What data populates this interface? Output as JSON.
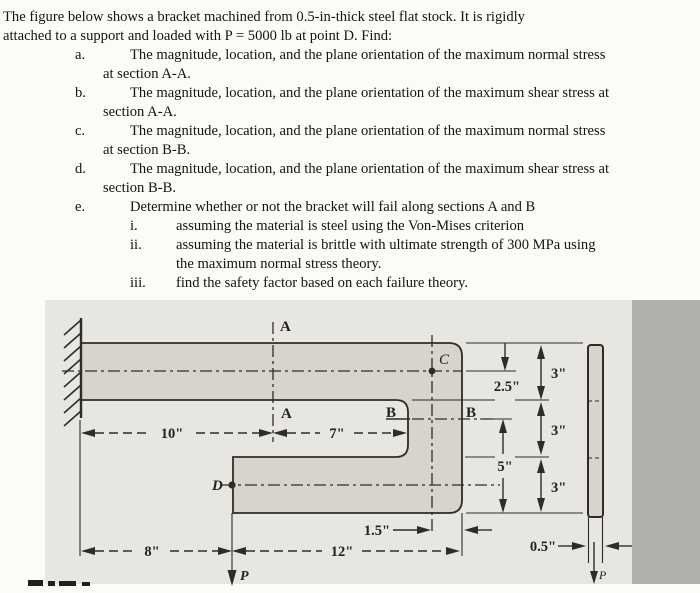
{
  "problem": {
    "intro": [
      "The figure below shows a bracket machined from 0.5-in-thick steel flat stock. It is rigidly",
      "attached to a support and loaded with P = 5000 lb at point D. Find:"
    ],
    "items": [
      {
        "label": "a.",
        "line1": "The magnitude, location, and the plane orientation of the maximum normal stress",
        "line2": "at section A-A."
      },
      {
        "label": "b.",
        "line1": "The magnitude, location, and the plane orientation of the maximum shear stress at",
        "line2": "section A-A."
      },
      {
        "label": "c.",
        "line1": "The magnitude, location, and the plane orientation of the maximum normal stress",
        "line2": "at section B-B."
      },
      {
        "label": "d.",
        "line1": "The magnitude, location, and the plane orientation of the maximum shear stress at",
        "line2": "section B-B."
      },
      {
        "label": "e.",
        "line1": "Determine whether or not the bracket will fail along sections A and B"
      }
    ],
    "subitems": [
      {
        "label": "i.",
        "line1": "assuming the material is steel using the Von-Mises criterion"
      },
      {
        "label": "ii.",
        "line1": "assuming the material is brittle with ultimate strength of 300 MPa using",
        "line2": "the maximum normal stress theory."
      },
      {
        "label": "iii.",
        "line1": "find the safety factor based on each failure theory."
      }
    ]
  },
  "figure": {
    "section_labels": {
      "a_top": "A",
      "a_bottom": "A",
      "b_left": "B",
      "b_right": "B"
    },
    "point_labels": {
      "c": "C",
      "d": "D",
      "p_main": "P",
      "p_side": "P"
    },
    "dimensions": {
      "wall_to_aa": "10\"",
      "aa_to_notch": "7\"",
      "wall_to_p": "8\"",
      "p_to_edge": "12\"",
      "c_to_edge": "1.5\"",
      "top_to_c": "2.5\"",
      "seg_top": "3\"",
      "seg_mid": "3\"",
      "seg_bot": "3\"",
      "bb_to_bottom": "5\"",
      "thickness": "0.5\""
    },
    "colors": {
      "panel": "#e8e6e0",
      "edge_band": "#b1afab",
      "part_fill": "#d7d4cc",
      "line": "#2e2c28",
      "text": "#141414"
    }
  }
}
